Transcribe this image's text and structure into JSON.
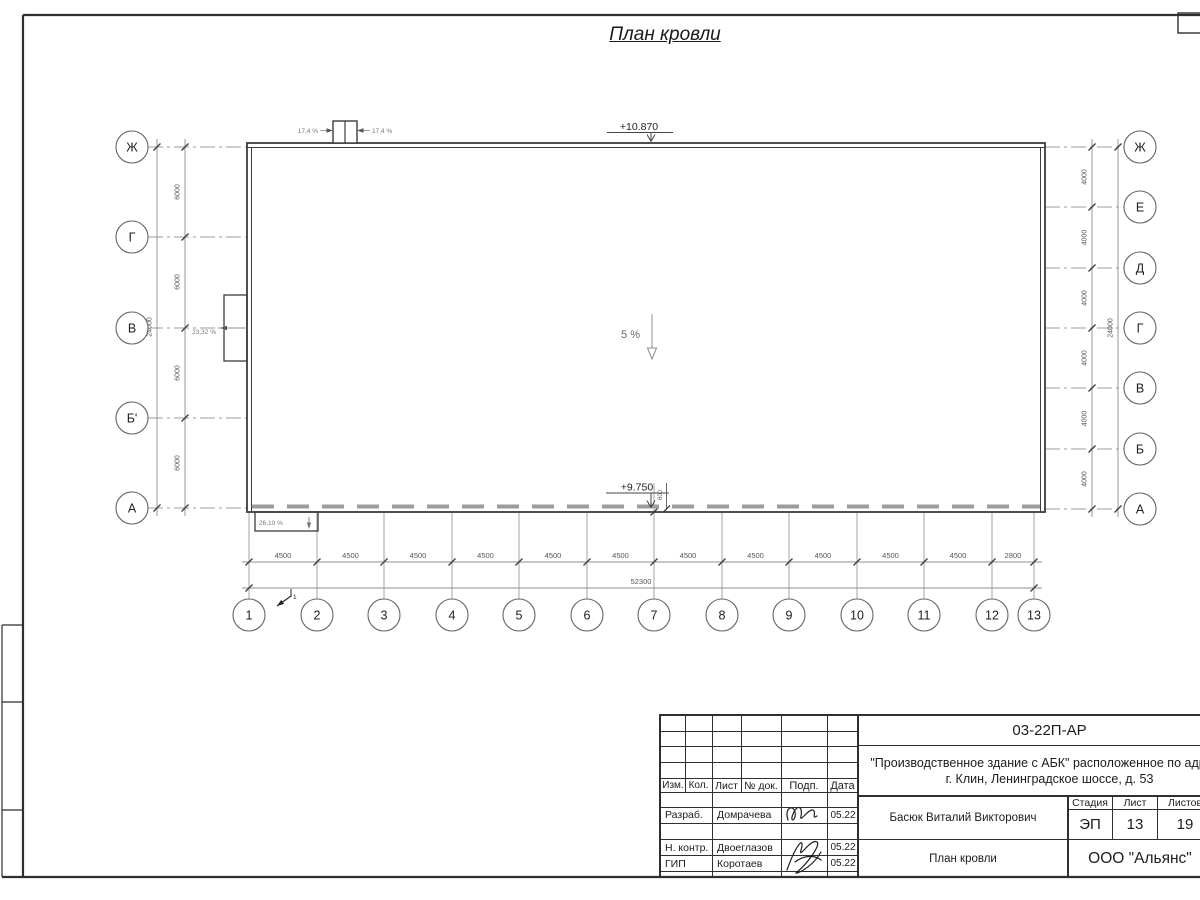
{
  "page": {
    "title": "План кровли"
  },
  "drawing": {
    "elevations": {
      "roof_top": "+10.870",
      "roof_low": "+9.750",
      "parapet_offset": "600"
    },
    "slopes": {
      "center": "5 %",
      "hatch_left": "17,4 %",
      "hatch_right": "17,4 %",
      "west_wall": "23,32 %",
      "south_canopy": "26,10 %"
    },
    "view_marker": "1",
    "axes": {
      "left": {
        "labels": [
          "Ж",
          "Г",
          "В",
          "Б'",
          "А"
        ],
        "spacing_dims": [
          "6000",
          "6000",
          "6000",
          "6000"
        ],
        "total_dim": "24000"
      },
      "right": {
        "labels": [
          "Ж",
          "Е",
          "Д",
          "Г",
          "В",
          "Б",
          "А"
        ],
        "spacing_dims": [
          "4000",
          "4000",
          "4000",
          "4000",
          "4000",
          "4000"
        ],
        "total_dim": "24000"
      },
      "bottom": {
        "labels": [
          "1",
          "2",
          "3",
          "4",
          "5",
          "6",
          "7",
          "8",
          "9",
          "10",
          "11",
          "12",
          "13"
        ],
        "spacing_dims": [
          "4500",
          "4500",
          "4500",
          "4500",
          "4500",
          "4500",
          "4500",
          "4500",
          "4500",
          "4500",
          "4500",
          "2800"
        ],
        "total_dim": "52300"
      }
    }
  },
  "title_block": {
    "doc_number": "03-22П-АР",
    "project_line1": "\"Производственное здание с АБК\" расположенное по адресу:",
    "project_line2": "г. Клин, Ленинградское шоссе, д. 53",
    "revision_headers": [
      "Изм.",
      "Кол.",
      "Лист",
      "№ док.",
      "Подп.",
      "Дата"
    ],
    "rows": [
      {
        "role": "Разраб.",
        "name": "Домрачева",
        "date": "05.22"
      },
      {
        "role": "Н. контр.",
        "name": "Двоеглазов",
        "date": "05.22"
      },
      {
        "role": "ГИП",
        "name": "Коротаев",
        "date": "05.22"
      }
    ],
    "approver": "Басюк Виталий Викторович",
    "stage_header": "Стадия",
    "sheet_header": "Лист",
    "sheets_header": "Листов",
    "stage": "ЭП",
    "sheet_number": "13",
    "sheets_total": "19",
    "drawing_title": "План кровли",
    "company": "ООО \"Альянс\""
  },
  "colors": {
    "line_dark": "#3c3c3c",
    "line_gray": "#9c9c9c",
    "text_dim": "#666666"
  }
}
